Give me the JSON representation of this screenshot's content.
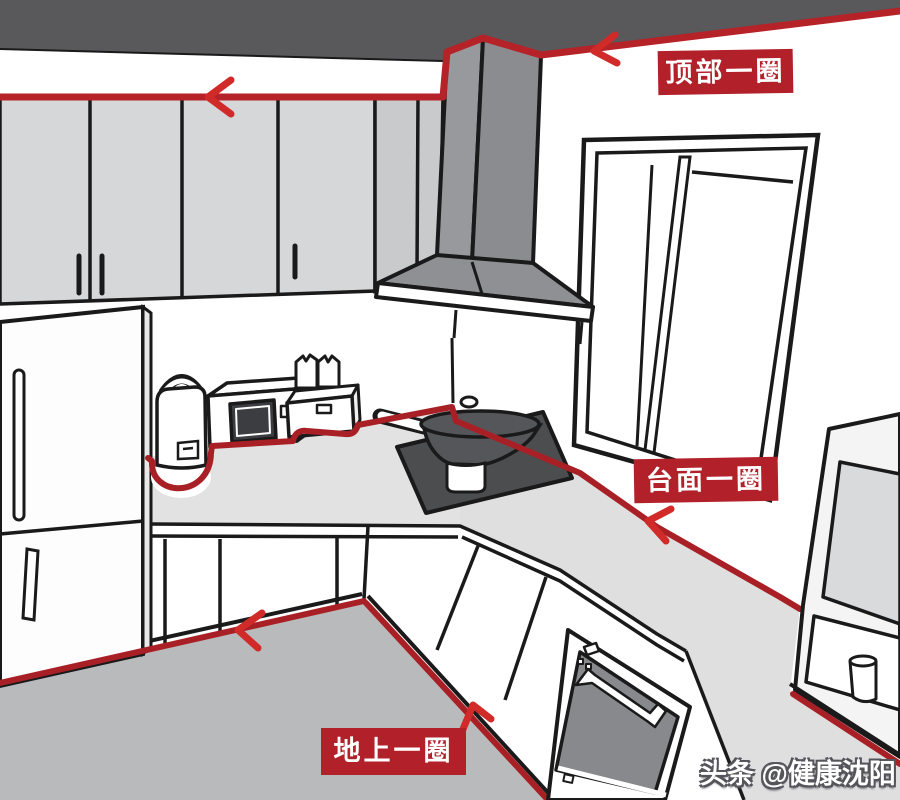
{
  "illustration": {
    "labels": {
      "top_perimeter": {
        "text": "顶部一圈"
      },
      "counter_perimeter": {
        "text": "台面一圈"
      },
      "floor_perimeter": {
        "text": "地上一圈"
      }
    },
    "watermark": {
      "site": "头条",
      "account": "@健康沈阳"
    },
    "colors": {
      "annotation_line_red": "#a82025",
      "label_background_red": "#b2202a",
      "arrow_red": "#d02b28",
      "ceiling_gray": "#59595b",
      "cabinet_gray": "#d6d7d8",
      "hood_gray": "#8f9093",
      "counter_gray": "#e2e2e3",
      "floor_gray": "#b9babc",
      "outline_black": "#1a1a1b"
    },
    "objects": [
      "ceiling",
      "upper-cabinets",
      "range-hood",
      "window",
      "refrigerator",
      "rice-cooker",
      "microwave",
      "bread-maker",
      "cooktop",
      "wok",
      "countertop",
      "base-cabinets",
      "oven",
      "side-cabinet",
      "cup",
      "floor"
    ]
  }
}
